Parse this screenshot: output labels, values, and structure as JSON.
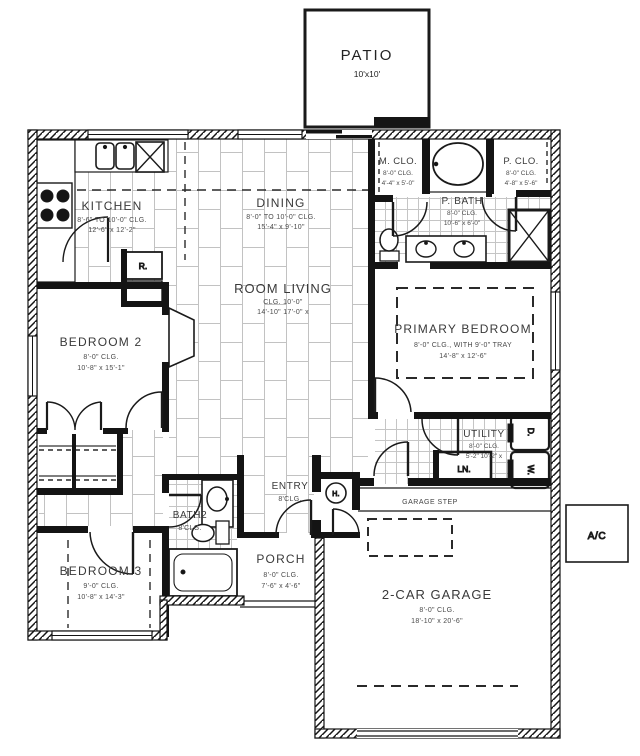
{
  "patio": {
    "name": "PATIO",
    "size": "10'x10'"
  },
  "kitchen": {
    "name": "KITCHEN",
    "clg": "8'-6\" TO 10'-0\" CLG.",
    "size": "12'-6\" x 12'-2\""
  },
  "dining": {
    "name": "DINING",
    "clg": "8'-0\" TO 10'-0\" CLG.",
    "size": "15'-4\" x 9'-10\""
  },
  "living": {
    "name": "ROOM LIVING",
    "clg": "CLG. 10'-0\"",
    "size": "14'-10\" 17'-0\" x"
  },
  "m_closet": {
    "name": "M. CLO.",
    "clg": "8'-0\" CLG.",
    "size": "4'-4\" x 5'-0\""
  },
  "p_bath": {
    "name": "P. BATH",
    "clg": "8'-0\" CLG.",
    "size": "10'-6\" x 6'-0\""
  },
  "p_closet": {
    "name": "P. CLO.",
    "clg": "8'-0\" CLG.",
    "size": "4'-8\" x 5'-6\""
  },
  "primary_bedroom": {
    "name": "PRIMARY BEDROOM",
    "clg": "8'-0\" CLG., WITH 9'-0\" TRAY",
    "size": "14'-8\" x 12'-6\""
  },
  "bedroom2": {
    "name": "BEDROOM 2",
    "clg": "8'-0\" CLG.",
    "size": "10'-8\" x 15'-1\""
  },
  "bedroom3": {
    "name": "BEDROOM 3",
    "clg": "9'-0\" CLG.",
    "size": "10'-8\" x 14'-3\""
  },
  "utility": {
    "name": "UTILITY",
    "clg": "8'-0\" CLG.",
    "size": "5'-2\" 10'-2\" x"
  },
  "bath2": {
    "name": "BATH2",
    "clg": "8'CLG."
  },
  "entry": {
    "name": "ENTRY",
    "clg": "8'CLG."
  },
  "porch": {
    "name": "PORCH",
    "clg": "8'-0\" CLG.",
    "size": "7'-6\" x 4'-6\""
  },
  "garage": {
    "name": "2-CAR GARAGE",
    "clg": "8'-0\" CLG.",
    "size": "18'-10\" x 20'-6\"",
    "step": "GARAGE STEP"
  },
  "ac_unit": {
    "label": "A/C"
  },
  "fixtures": {
    "refrigerator": "R.",
    "linen": "LN.",
    "dryer": "D.",
    "washer": "W.",
    "water_heater": "H."
  }
}
